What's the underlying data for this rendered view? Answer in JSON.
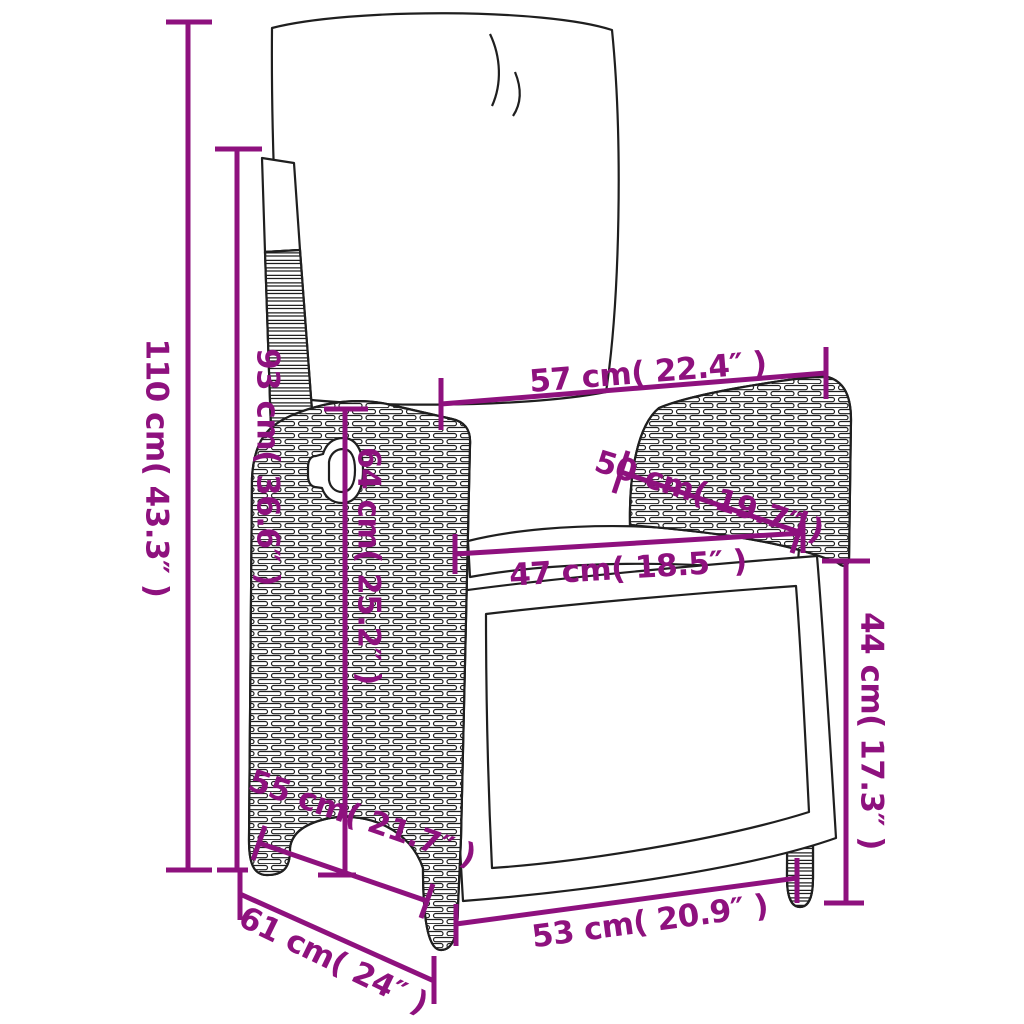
{
  "diagram": {
    "kind": "product-dimension-diagram",
    "subject": "reclining poly rattan garden chair with cushions (line art)",
    "background_color": "#FFFFFF",
    "line_art_color": "#1F1F1F",
    "dimension_color": "#8E117E",
    "dimensions": [
      {
        "id": "total-height",
        "label": "110 cm( 43.3″ )",
        "value_cm": 110,
        "value_in": 43.3
      },
      {
        "id": "back-height",
        "label": "93 cm( 36.6″ )",
        "value_cm": 93,
        "value_in": 36.6
      },
      {
        "id": "top-width",
        "label": "57 cm( 22.4″ )",
        "value_cm": 57,
        "value_in": 22.4
      },
      {
        "id": "armrest-depth",
        "label": "50 cm( 19.7″ )",
        "value_cm": 50,
        "value_in": 19.7
      },
      {
        "id": "seat-width",
        "label": "47 cm( 18.5″ )",
        "value_cm": 47,
        "value_in": 18.5
      },
      {
        "id": "side-height",
        "label": "64 cm( 25.2″ )",
        "value_cm": 64,
        "value_in": 25.2
      },
      {
        "id": "seat-height",
        "label": "44 cm( 17.3″ )",
        "value_cm": 44,
        "value_in": 17.3
      },
      {
        "id": "side-depth",
        "label": "55 cm( 21.7″ )",
        "value_cm": 55,
        "value_in": 21.7
      },
      {
        "id": "bottom-width",
        "label": "53 cm( 20.9″ )",
        "value_cm": 53,
        "value_in": 20.9
      },
      {
        "id": "total-depth",
        "label": "61 cm( 24″ )",
        "value_cm": 61,
        "value_in": 24
      }
    ]
  }
}
